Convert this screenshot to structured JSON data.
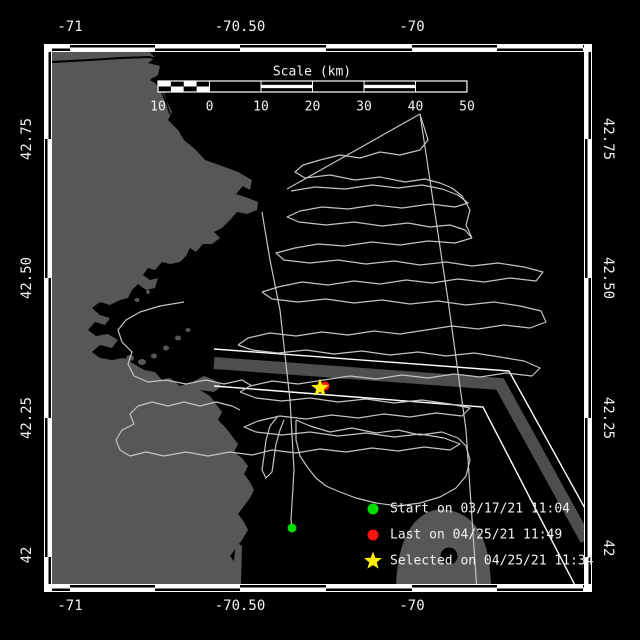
{
  "colors": {
    "background": "#000000",
    "land": "#575757",
    "water": "#000000",
    "track": "#c3c3c3",
    "lane_band": "#4e4e4e",
    "lane_line": "#ffffff",
    "text": "#f2f2f2",
    "start_marker": "#00dd00",
    "last_marker": "#ff1212",
    "selected_marker": "#ffee00"
  },
  "axes": {
    "top_ticks": [
      {
        "label": "-71",
        "x": 70
      },
      {
        "label": "-70.50",
        "x": 240
      },
      {
        "label": "-70",
        "x": 412
      }
    ],
    "bottom_ticks": [
      {
        "label": "-71",
        "x": 70
      },
      {
        "label": "-70.50",
        "x": 240
      },
      {
        "label": "-70",
        "x": 412
      }
    ],
    "left_ticks": [
      {
        "label": "42.75",
        "y": 139
      },
      {
        "label": "42.50",
        "y": 278
      },
      {
        "label": "42.25",
        "y": 418
      },
      {
        "label": "42",
        "y": 555
      }
    ],
    "right_ticks": [
      {
        "label": "42.75",
        "y": 139
      },
      {
        "label": "42.50",
        "y": 278
      },
      {
        "label": "42.25",
        "y": 418
      },
      {
        "label": "42",
        "y": 548
      }
    ]
  },
  "map_frame": {
    "x0": 52,
    "y0": 52,
    "x1": 584,
    "y1": 584,
    "lon_ticks_x": [
      70,
      155,
      240,
      326,
      412,
      497,
      583
    ],
    "lat_ticks_y": [
      139,
      278,
      418,
      557
    ]
  },
  "scale_bar": {
    "title": "Scale (km)",
    "title_x": 312,
    "title_y": 72,
    "x": 158,
    "y": 81,
    "width": 309,
    "height": 11,
    "segments": [
      "checker",
      "solid",
      "striped",
      "solid",
      "striped",
      "solid"
    ],
    "tick_labels": [
      "10",
      "0",
      "10",
      "20",
      "30",
      "40",
      "50"
    ],
    "labels_y": 107
  },
  "legend": {
    "marker_x": 373,
    "label_x": 390,
    "items": [
      {
        "marker": "circle",
        "color": "#00dd00",
        "label": "Start on 03/17/21 11:04",
        "y": 509
      },
      {
        "marker": "circle",
        "color": "#ff1212",
        "label": "Last on 04/25/21 11:49",
        "y": 535
      },
      {
        "marker": "star",
        "color": "#ffee00",
        "label": "Selected on 04/25/21 11:34",
        "y": 561
      }
    ]
  },
  "markers": [
    {
      "name": "start-marker",
      "shape": "circle",
      "color": "#00dd00",
      "x": 292,
      "y": 528,
      "r": 4.5
    },
    {
      "name": "last-marker",
      "shape": "circle",
      "color": "#ff1212",
      "x": 325,
      "y": 386,
      "r": 4.5
    },
    {
      "name": "selected-marker",
      "shape": "star",
      "color": "#ffee00",
      "x": 320,
      "y": 388,
      "r": 9.5
    }
  ],
  "lane": {
    "band": [
      [
        214,
        363
      ],
      [
        500,
        384
      ],
      [
        586,
        540
      ]
    ],
    "upper_line": [
      [
        214,
        349
      ],
      [
        509,
        371
      ],
      [
        597,
        530
      ]
    ],
    "lower_line": [
      [
        214,
        386
      ],
      [
        483,
        407
      ],
      [
        580,
        595
      ]
    ]
  },
  "tracks": [
    [
      [
        287,
        189
      ],
      [
        420,
        114
      ]
    ],
    [
      [
        420,
        114
      ],
      [
        448,
        300
      ],
      [
        466,
        430
      ],
      [
        477,
        592
      ]
    ],
    [
      [
        262,
        212
      ],
      [
        270,
        260
      ],
      [
        280,
        310
      ],
      [
        290,
        400
      ],
      [
        294,
        470
      ],
      [
        291,
        520
      ],
      [
        292,
        528
      ]
    ],
    [
      [
        420,
        114
      ],
      [
        428,
        140
      ],
      [
        420,
        150
      ],
      [
        400,
        155
      ],
      [
        380,
        152
      ],
      [
        360,
        158
      ],
      [
        340,
        155
      ],
      [
        320,
        160
      ],
      [
        303,
        165
      ],
      [
        295,
        172
      ],
      [
        305,
        178
      ],
      [
        330,
        175
      ],
      [
        355,
        180
      ],
      [
        380,
        177
      ],
      [
        405,
        182
      ],
      [
        425,
        179
      ],
      [
        440,
        183
      ],
      [
        452,
        188
      ],
      [
        462,
        196
      ],
      [
        470,
        210
      ],
      [
        466,
        225
      ],
      [
        472,
        238
      ]
    ],
    [
      [
        291,
        191
      ],
      [
        315,
        187
      ],
      [
        345,
        189
      ],
      [
        372,
        185
      ],
      [
        398,
        188
      ],
      [
        422,
        185
      ],
      [
        442,
        189
      ],
      [
        458,
        195
      ],
      [
        468,
        203
      ],
      [
        455,
        207
      ],
      [
        430,
        204
      ],
      [
        402,
        208
      ],
      [
        375,
        205
      ],
      [
        348,
        209
      ],
      [
        322,
        207
      ],
      [
        300,
        211
      ],
      [
        287,
        217
      ],
      [
        299,
        222
      ],
      [
        326,
        225
      ],
      [
        354,
        222
      ],
      [
        382,
        226
      ],
      [
        408,
        223
      ],
      [
        430,
        227
      ],
      [
        450,
        225
      ],
      [
        465,
        230
      ],
      [
        472,
        238
      ]
    ],
    [
      [
        472,
        238
      ],
      [
        455,
        243
      ],
      [
        428,
        241
      ],
      [
        400,
        245
      ],
      [
        372,
        242
      ],
      [
        344,
        246
      ],
      [
        318,
        244
      ],
      [
        295,
        248
      ],
      [
        276,
        253
      ],
      [
        284,
        260
      ],
      [
        310,
        263
      ],
      [
        338,
        260
      ],
      [
        366,
        264
      ],
      [
        394,
        261
      ],
      [
        420,
        265
      ],
      [
        446,
        262
      ],
      [
        472,
        266
      ],
      [
        498,
        263
      ],
      [
        524,
        267
      ],
      [
        543,
        272
      ],
      [
        536,
        281
      ],
      [
        510,
        278
      ],
      [
        484,
        282
      ],
      [
        458,
        279
      ],
      [
        432,
        283
      ],
      [
        406,
        280
      ],
      [
        380,
        284
      ],
      [
        354,
        281
      ],
      [
        328,
        285
      ],
      [
        302,
        282
      ],
      [
        278,
        287
      ],
      [
        262,
        292
      ]
    ],
    [
      [
        262,
        292
      ],
      [
        272,
        299
      ],
      [
        298,
        302
      ],
      [
        326,
        299
      ],
      [
        354,
        303
      ],
      [
        382,
        300
      ],
      [
        410,
        304
      ],
      [
        438,
        301
      ],
      [
        466,
        305
      ],
      [
        494,
        302
      ],
      [
        520,
        306
      ],
      [
        541,
        311
      ],
      [
        546,
        322
      ],
      [
        530,
        328
      ],
      [
        504,
        325
      ],
      [
        478,
        329
      ],
      [
        452,
        326
      ],
      [
        426,
        330
      ],
      [
        400,
        334
      ],
      [
        374,
        331
      ],
      [
        348,
        335
      ],
      [
        322,
        332
      ],
      [
        296,
        336
      ],
      [
        270,
        333
      ],
      [
        248,
        338
      ],
      [
        238,
        345
      ]
    ],
    [
      [
        238,
        345
      ],
      [
        252,
        350
      ],
      [
        278,
        353
      ],
      [
        306,
        350
      ],
      [
        334,
        354
      ],
      [
        362,
        351
      ],
      [
        390,
        355
      ],
      [
        418,
        352
      ],
      [
        446,
        356
      ],
      [
        474,
        353
      ],
      [
        500,
        357
      ],
      [
        524,
        361
      ],
      [
        540,
        368
      ],
      [
        532,
        376
      ],
      [
        506,
        373
      ],
      [
        480,
        377
      ],
      [
        454,
        374
      ],
      [
        428,
        378
      ],
      [
        402,
        375
      ],
      [
        376,
        379
      ],
      [
        350,
        376
      ],
      [
        324,
        380
      ],
      [
        298,
        384
      ],
      [
        272,
        381
      ],
      [
        250,
        386
      ],
      [
        240,
        392
      ]
    ],
    [
      [
        240,
        392
      ],
      [
        256,
        398
      ],
      [
        282,
        401
      ],
      [
        310,
        398
      ],
      [
        338,
        402
      ],
      [
        366,
        399
      ],
      [
        394,
        403
      ],
      [
        422,
        400
      ],
      [
        450,
        404
      ],
      [
        470,
        408
      ],
      [
        462,
        416
      ],
      [
        436,
        413
      ],
      [
        410,
        417
      ],
      [
        384,
        414
      ],
      [
        358,
        418
      ],
      [
        332,
        415
      ],
      [
        306,
        419
      ],
      [
        280,
        416
      ],
      [
        258,
        421
      ],
      [
        244,
        427
      ],
      [
        256,
        432
      ],
      [
        282,
        435
      ],
      [
        310,
        432
      ],
      [
        338,
        436
      ],
      [
        366,
        433
      ],
      [
        394,
        437
      ],
      [
        420,
        434
      ],
      [
        444,
        438
      ],
      [
        460,
        444
      ],
      [
        450,
        450
      ],
      [
        424,
        447
      ],
      [
        398,
        451
      ],
      [
        372,
        448
      ],
      [
        346,
        452
      ],
      [
        320,
        449
      ],
      [
        296,
        453
      ],
      [
        272,
        450
      ],
      [
        252,
        455
      ]
    ],
    [
      [
        184,
        302
      ],
      [
        160,
        306
      ],
      [
        140,
        312
      ],
      [
        126,
        320
      ],
      [
        118,
        330
      ],
      [
        122,
        342
      ],
      [
        132,
        352
      ],
      [
        128,
        364
      ],
      [
        134,
        376
      ],
      [
        148,
        382
      ],
      [
        166,
        380
      ],
      [
        186,
        384
      ],
      [
        206,
        380
      ],
      [
        224,
        384
      ],
      [
        242,
        380
      ],
      [
        252,
        386
      ]
    ],
    [
      [
        252,
        455
      ],
      [
        230,
        452
      ],
      [
        208,
        456
      ],
      [
        186,
        452
      ],
      [
        164,
        456
      ],
      [
        146,
        452
      ],
      [
        130,
        456
      ],
      [
        120,
        450
      ],
      [
        116,
        440
      ],
      [
        122,
        430
      ],
      [
        134,
        424
      ],
      [
        130,
        414
      ],
      [
        138,
        406
      ],
      [
        152,
        402
      ],
      [
        168,
        406
      ],
      [
        184,
        402
      ],
      [
        200,
        406
      ],
      [
        216,
        402
      ],
      [
        232,
        406
      ],
      [
        240,
        410
      ]
    ],
    [
      [
        278,
        416
      ],
      [
        270,
        426
      ],
      [
        266,
        440
      ],
      [
        264,
        456
      ],
      [
        262,
        470
      ],
      [
        266,
        478
      ],
      [
        272,
        472
      ],
      [
        274,
        458
      ],
      [
        276,
        444
      ],
      [
        280,
        430
      ],
      [
        284,
        420
      ]
    ],
    [
      [
        296,
        420
      ],
      [
        310,
        426
      ],
      [
        330,
        432
      ],
      [
        352,
        428
      ],
      [
        376,
        433
      ],
      [
        398,
        430
      ],
      [
        420,
        435
      ],
      [
        442,
        432
      ],
      [
        458,
        438
      ],
      [
        466,
        446
      ],
      [
        470,
        460
      ],
      [
        466,
        476
      ],
      [
        456,
        488
      ],
      [
        440,
        497
      ],
      [
        420,
        503
      ],
      [
        398,
        506
      ],
      [
        376,
        503
      ],
      [
        356,
        498
      ],
      [
        340,
        492
      ],
      [
        326,
        486
      ],
      [
        316,
        478
      ],
      [
        308,
        468
      ],
      [
        300,
        456
      ],
      [
        296,
        440
      ],
      [
        296,
        420
      ]
    ]
  ]
}
